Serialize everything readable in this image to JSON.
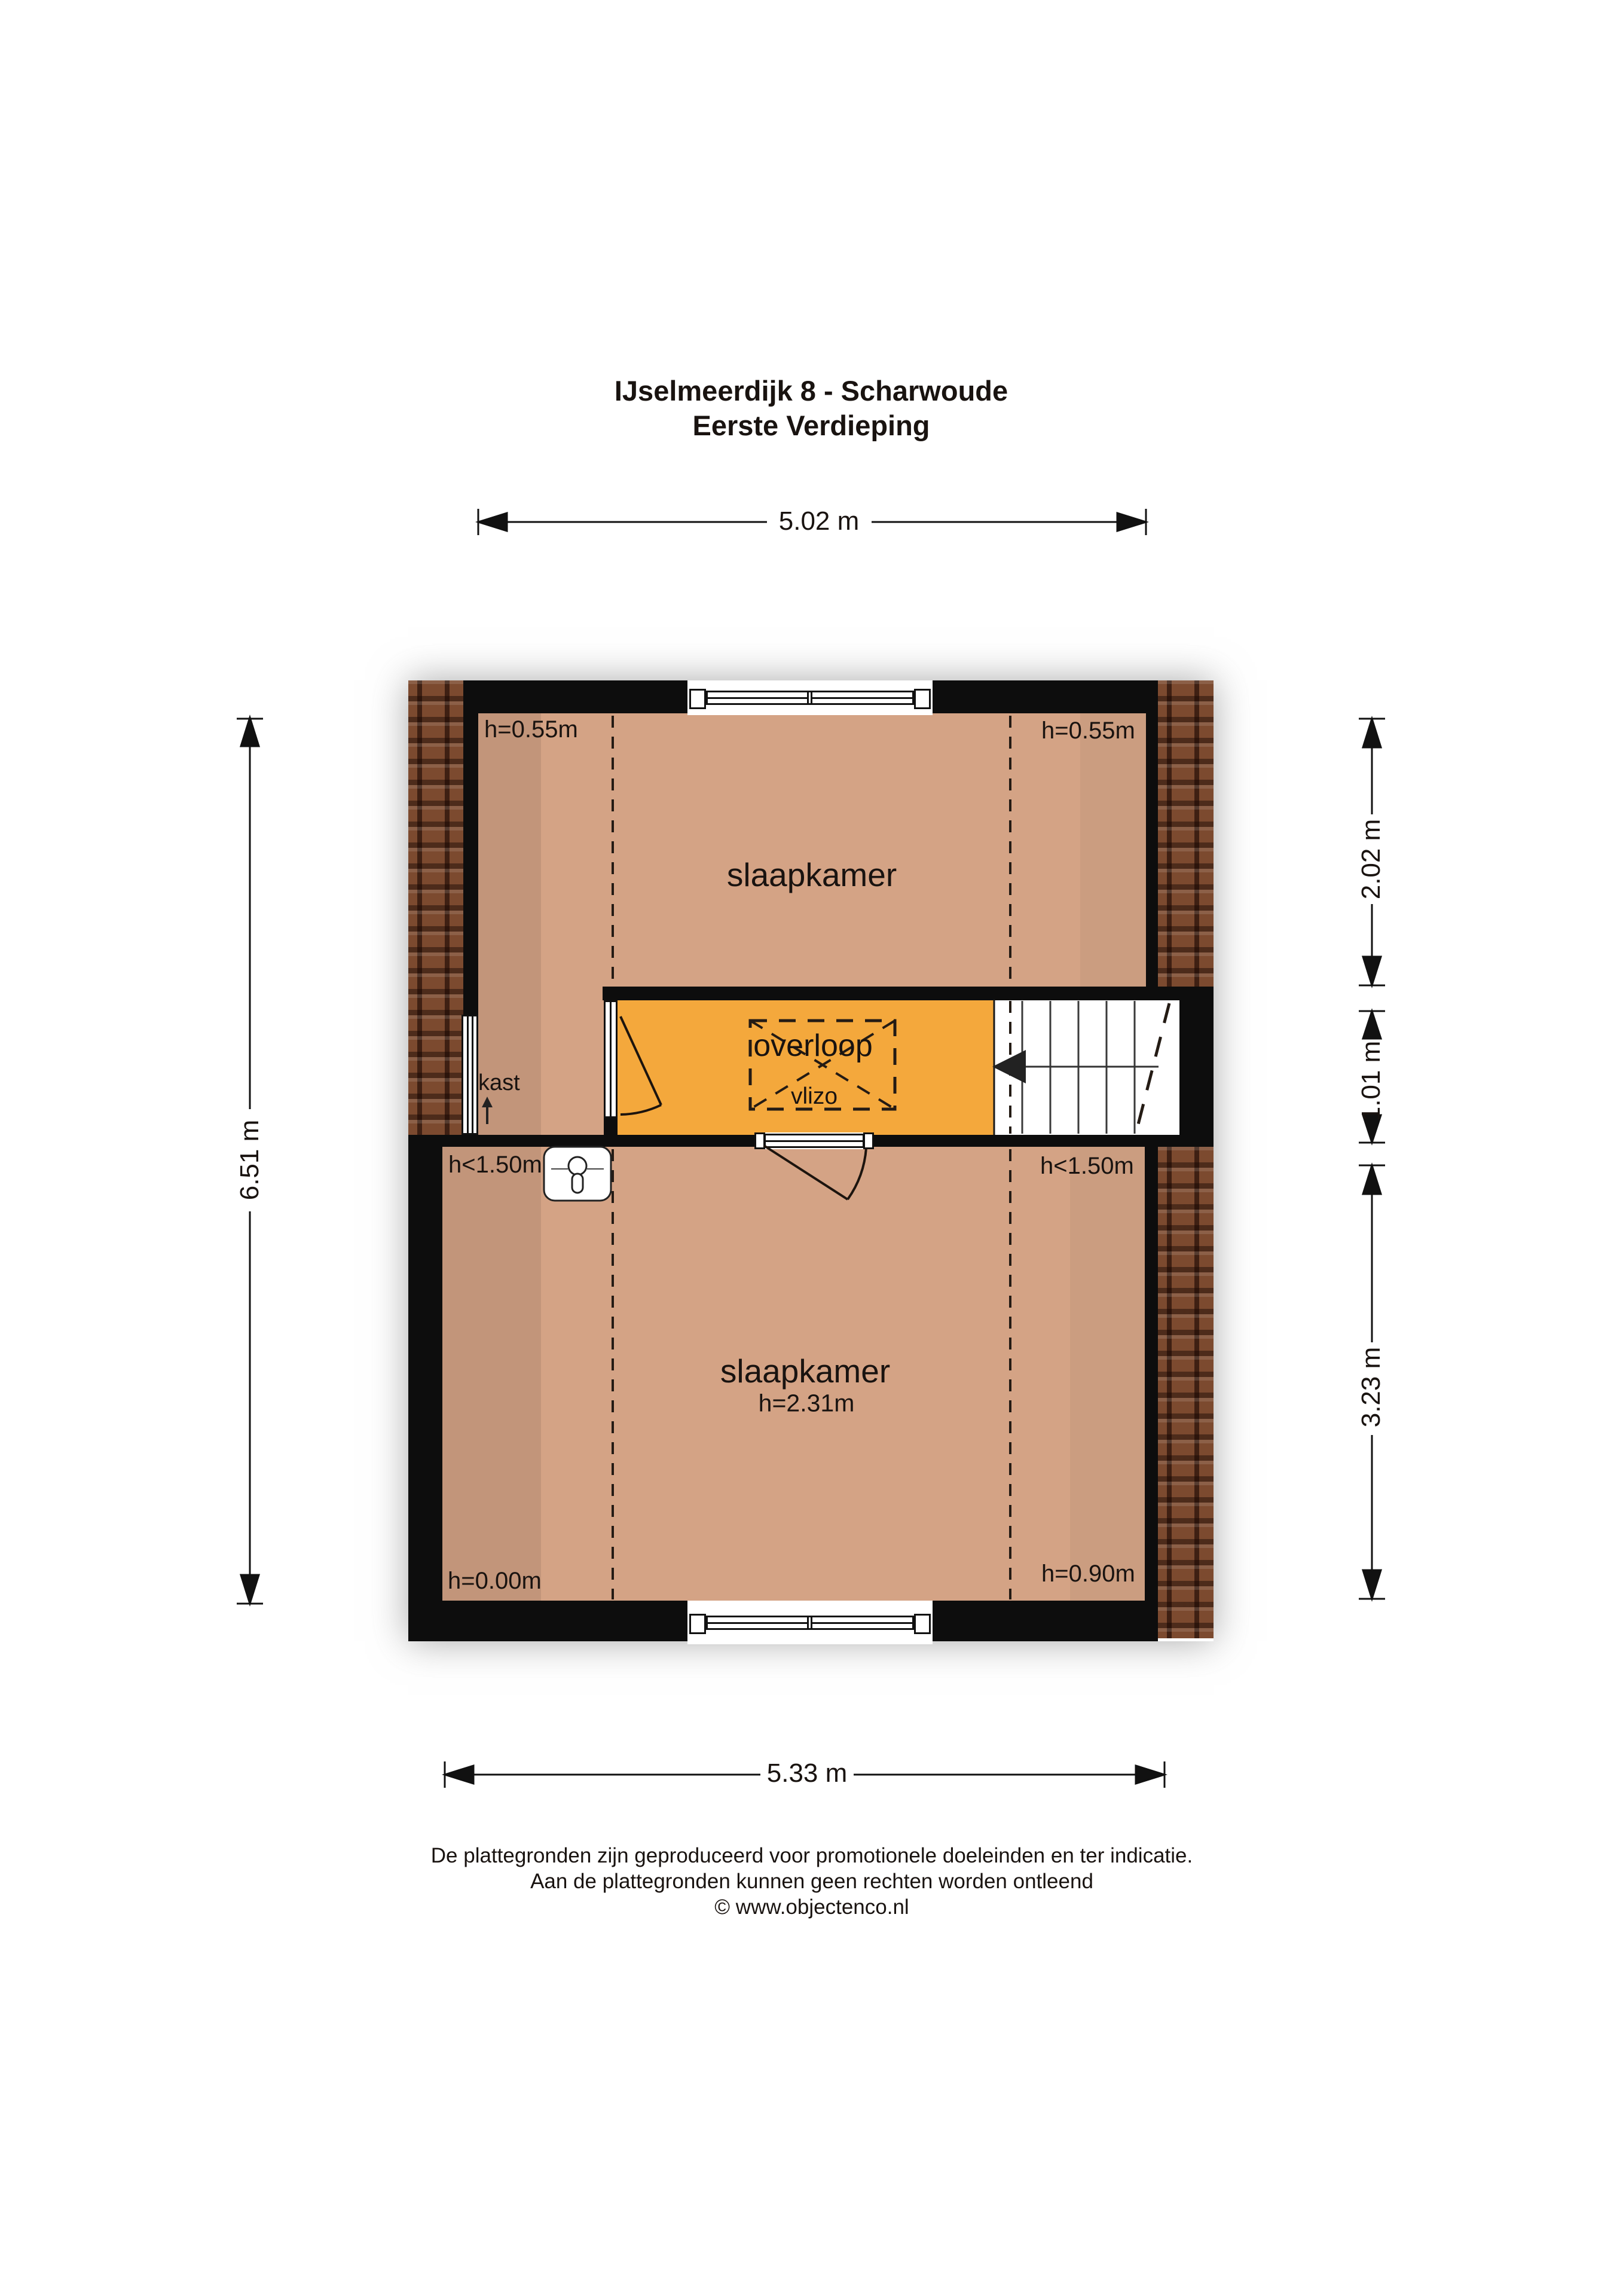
{
  "title": {
    "line1": "IJselmeerdijk 8 - Scharwoude",
    "line2": "Eerste Verdieping"
  },
  "dimensions": {
    "top": "5.02 m",
    "left": "6.51 m",
    "right_top": "2.02 m",
    "right_middle": "1.01 m",
    "right_bottom": "3.23 m",
    "bottom": "5.33 m"
  },
  "rooms": {
    "bedroom_top": {
      "name": "slaapkamer",
      "height_left": "h=0.55m",
      "height_right": "h=0.55m"
    },
    "closet": {
      "name": "kast"
    },
    "landing": {
      "name": "overloop",
      "hatch_label": "vlizo"
    },
    "bedroom_bottom": {
      "name": "slaapkamer",
      "ceiling_height": "h=2.31m",
      "height_left_top": "h<1.50m",
      "height_right_top": "h<1.50m",
      "height_left_bottom": "h=0.00m",
      "height_right_bottom": "h=0.90m"
    }
  },
  "icons": {
    "closet_arrow": "up-arrow",
    "stairs_walkline_arrow": "left-arrow"
  },
  "footer": {
    "line1": "De plattegronden zijn geproduceerd voor promotionele doeleinden en ter indicatie.",
    "line2": "Aan de plattegronden kunnen geen rechten worden ontleend",
    "line3": "© www.objectenco.nl"
  },
  "colors": {
    "wall": "#0d0d0d",
    "floor": "#d4a385",
    "floor_dark": "#c2957a",
    "floor_mid": "#cb9d80",
    "landing": "#f4a83c",
    "brick": "#7c4a2f"
  }
}
